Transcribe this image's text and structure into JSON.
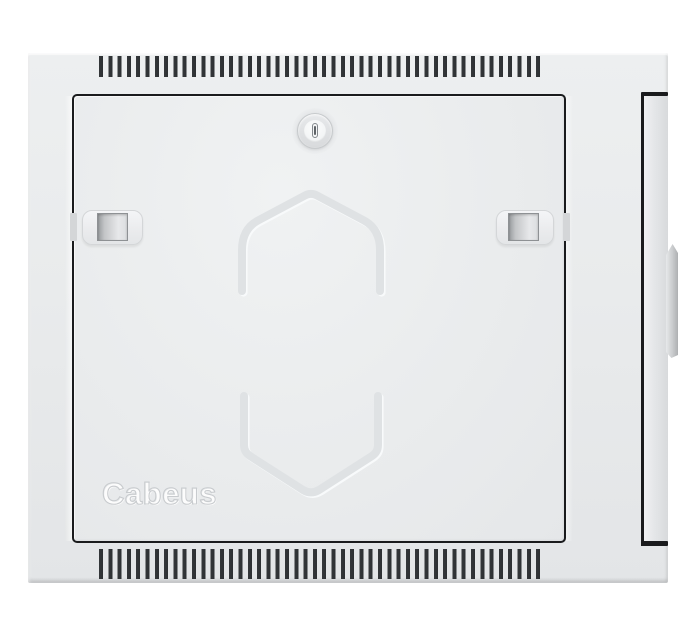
{
  "image": {
    "kind": "product-photo",
    "subject": "Wall-mounted telecom cabinet, front view, closed solid steel door",
    "background_color": "#ffffff"
  },
  "cabinet": {
    "brand": "Cabeus",
    "colors": {
      "body": "#e9ebec",
      "door": "#ecedef",
      "seam": "#1a1b1d",
      "vent_slots": "#34373a",
      "emboss_line": "#dfe2e4",
      "lock_face": "#f8f9fa",
      "side_panel_edge": "#d8dadc",
      "handle_edge": "#aeb0b2"
    },
    "features": {
      "vent_rows": 2,
      "door_latches": 2,
      "lock": "cylinder keyhole lock",
      "side_handles": 1
    }
  }
}
